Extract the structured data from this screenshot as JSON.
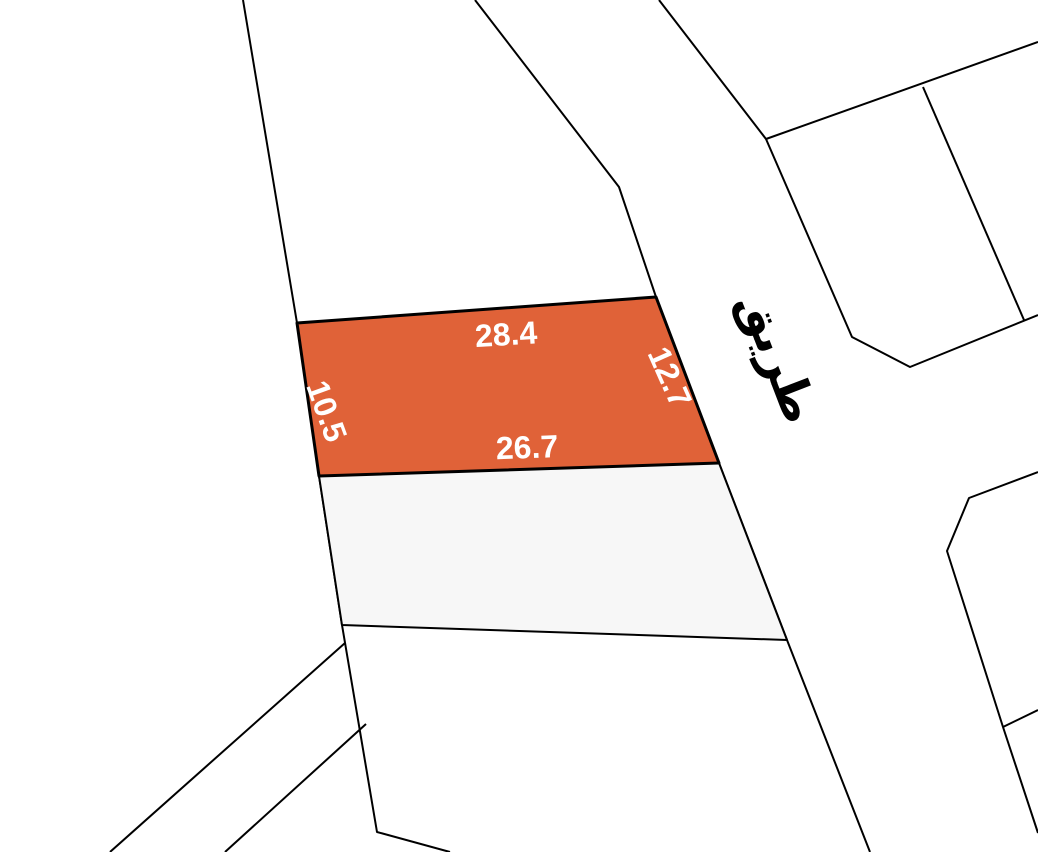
{
  "map": {
    "background_color": "#ffffff",
    "line_color": "#000000",
    "highlighted_parcel": {
      "fill": "#E06238",
      "points": "297,323 656,297 719,463 319,476",
      "label_color": "#ffffff",
      "dimensions": [
        {
          "side": "top",
          "text": "28.4",
          "transform": "translate(506,334) rotate(-3.5)"
        },
        {
          "side": "right",
          "text": "12.7",
          "transform": "translate(670,377) rotate(66)"
        },
        {
          "side": "bottom",
          "text": "26.7",
          "transform": "translate(527,447) rotate(-2)"
        },
        {
          "side": "left",
          "text": "10.5",
          "transform": "translate(327,411) rotate(70)"
        }
      ]
    },
    "neighbor_parcel": {
      "fill": "#F7F7F7",
      "points": "319,476 719,463 787,640 342,625"
    },
    "road_label": {
      "text": "طريق",
      "color": "#000000",
      "transform": "translate(779,357) rotate(69)"
    },
    "boundary_lines": [
      "243,0 297,323 319,476 342,625 377,832 450,852",
      "475,0 619,187 656,297 719,463 787,640 870,852",
      "659,0 766,139 852,337 910,367 1038,315",
      "766,139 1038,42",
      "923,87 1024,320",
      "1038,472 969,498 947,551 1003,727 1038,833",
      "1003,727 1038,710",
      "345,643 110,852",
      "366,724 225,852"
    ]
  }
}
